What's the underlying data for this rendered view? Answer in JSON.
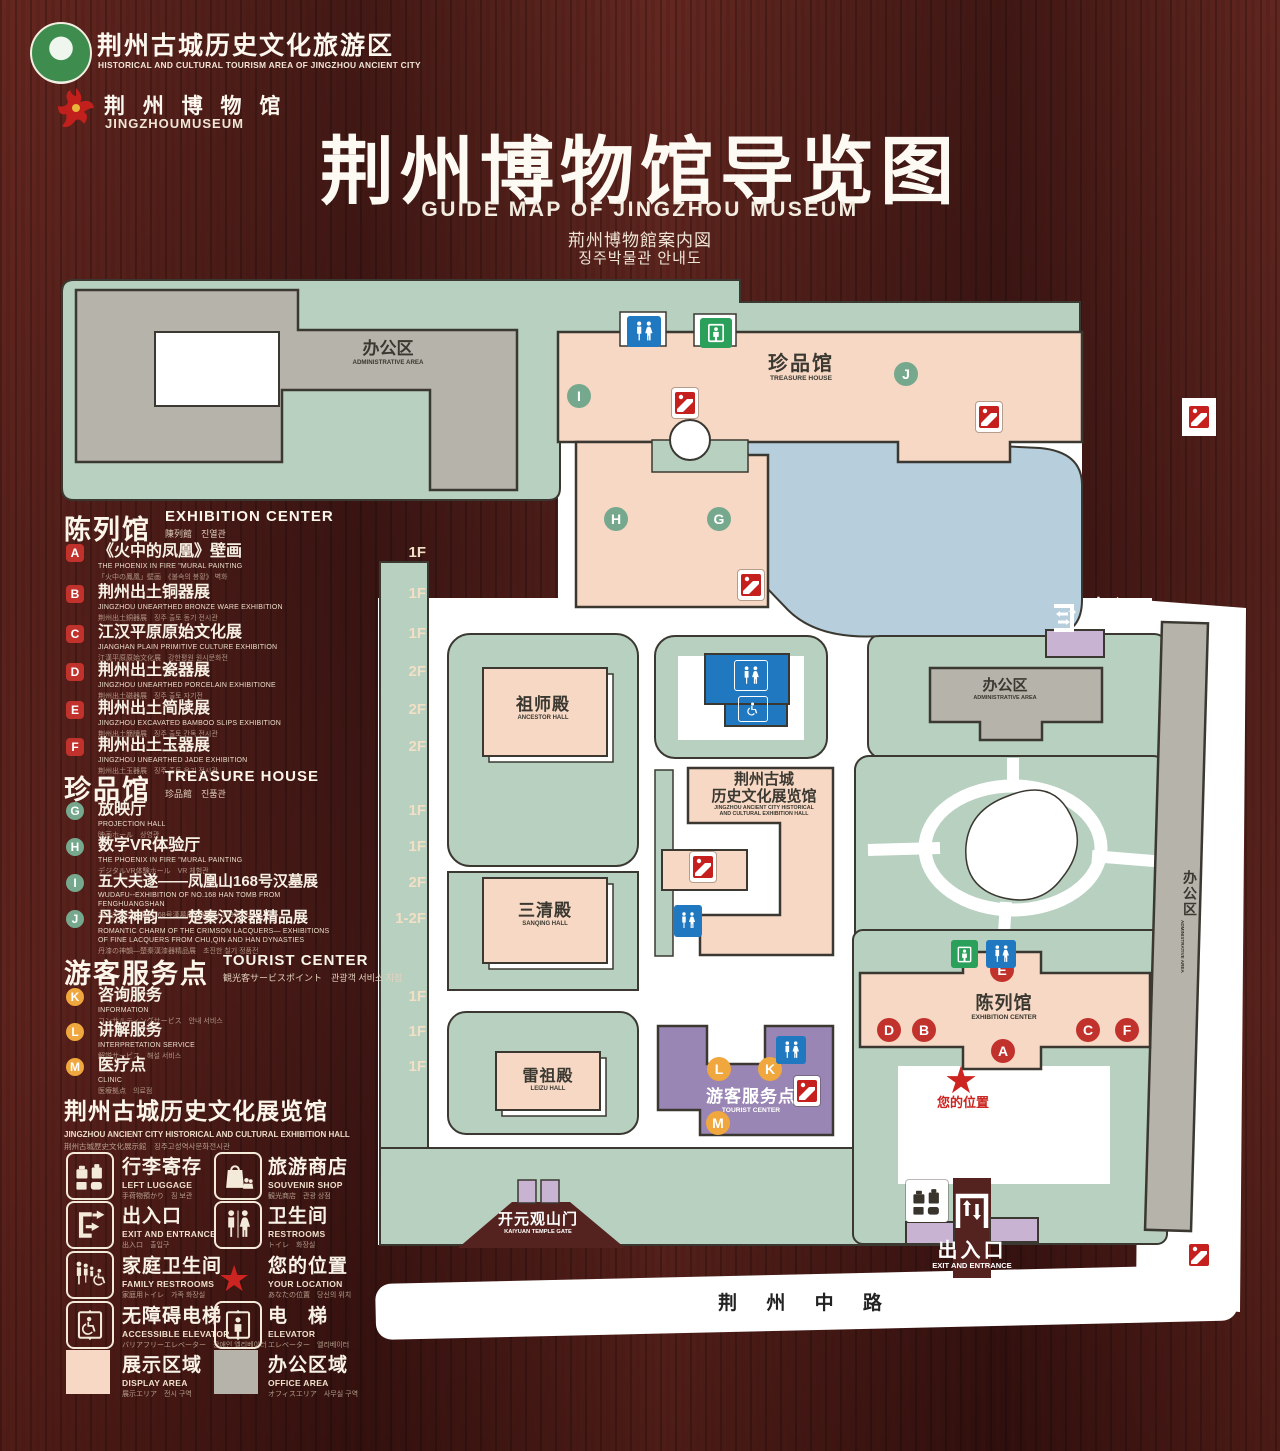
{
  "header": {
    "logo1_cn": "荆州古城历史文化旅游区",
    "logo1_en": "HISTORICAL AND CULTURAL TOURISM AREA OF JINGZHOU ANCIENT CITY",
    "logo2_cn": "荆 州 博 物 馆",
    "logo2_en": "JINGZHOUMUSEUM",
    "title_cn": "荆州博物馆导览图",
    "title_en": "GUIDE MAP OF JINGZHOU MUSEUM",
    "title_ja": "荊州博物館案内図",
    "title_ko": "징주박물관 안내도"
  },
  "sections": [
    {
      "title_cn": "陈列馆",
      "title_en": "EXHIBITION CENTER",
      "sub": "陳列館　진열관",
      "items": [
        {
          "letter": "A",
          "cn": "《火中的凤凰》壁画",
          "en": "THE PHOENIX IN FIRE \"MURAL PAINTING",
          "sub": "「火中の鳳凰」壁画　《불속의 봉황》 벽화",
          "floor": "1F"
        },
        {
          "letter": "B",
          "cn": "荆州出土铜器展",
          "en": "JINGZHOU UNEARTHED BRONZE WARE EXHIBITION",
          "sub": "荆州出土銅器展　징주 출토 동기 전시관",
          "floor": "1F"
        },
        {
          "letter": "C",
          "cn": "江汉平原原始文化展",
          "en": "JIANGHAN PLAIN PRIMITIVE CULTURE EXHIBITION",
          "sub": "江漢平原原始文化展　강한평원 원시문화전",
          "floor": "1F"
        },
        {
          "letter": "D",
          "cn": "荆州出土瓷器展",
          "en": "JINGZHOU UNEARTHED PORCELAIN EXHIBITIONE",
          "sub": "荆州出土磁器展　징주 출토 자기전",
          "floor": "2F"
        },
        {
          "letter": "E",
          "cn": "荆州出土简牍展",
          "en": "JINGZHOU EXCAVATED BAMBOO SLIPS EXHIBITION",
          "sub": "荆州出土簡牘展　징주 출토 간독 전시관",
          "floor": "2F"
        },
        {
          "letter": "F",
          "cn": "荆州出土玉器展",
          "en": "JINGZHOU UNEARTHED JADE EXHIBITION",
          "sub": "荆州出土玉器展　징주 출토 옥기 전시관",
          "floor": "2F"
        }
      ]
    },
    {
      "title_cn": "珍品馆",
      "title_en": "TREASURE HOUSE",
      "sub": "珍品館　진품관",
      "items": [
        {
          "letter": "G",
          "cn": "放映厅",
          "en": "PROJECTION HALL",
          "sub": "映画ホール　상영관",
          "floor": "1F"
        },
        {
          "letter": "H",
          "cn": "数字VR体验厅",
          "en": "THE PHOENIX IN FIRE \"MURAL PAINTING",
          "sub": "デジタルVR体験ホール　VR 체험관",
          "floor": "1F"
        },
        {
          "letter": "I",
          "cn": "五大夫遂——凤凰山168号汉墓展",
          "en": "WUDAFU--EXHIBITION OF NO.168 HAN TOMB FROM FENGHUANGSHAN",
          "sub": "五大夫遂—鳳凰山168号漢墓展　봉황산 168호 한묘전",
          "floor": "2F"
        },
        {
          "letter": "J",
          "cn": "丹漆神韵——楚秦汉漆器精品展",
          "en": "ROMANTIC CHARM OF THE CRIMSON LACQUERS— EXHIBITIONS OF FINE LACQUERS FROM CHU,QIN AND HAN DYNASTIES",
          "sub": "丹漆の神韻—楚秦漢漆器精品展　초진한 칠기 정품전",
          "floor": "1-2F"
        }
      ]
    },
    {
      "title_cn": "游客服务点",
      "title_en": "TOURIST CENTER",
      "sub": "観光客サービスポイント　관광객 서비스 지점",
      "items": [
        {
          "letter": "K",
          "cn": "咨询服务",
          "en": "INFORMATION",
          "sub": "コンサルティングサービス　안내 서비스",
          "floor": "1F"
        },
        {
          "letter": "L",
          "cn": "讲解服务",
          "en": "INTERPRETATION SERVICE",
          "sub": "解説サービス　해설 서비스",
          "floor": "1F"
        },
        {
          "letter": "M",
          "cn": "医疗点",
          "en": "CLINIC",
          "sub": "医療拠点　의료점",
          "floor": "1F"
        }
      ]
    }
  ],
  "hall_header": {
    "cn": "荆州古城历史文化展览馆",
    "en": "JINGZHOU ANCIENT CITY HISTORICAL AND CULTURAL EXHIBITION HALL",
    "sub": "荆州古城歴史文化展示館　징주고성역사문화전시관"
  },
  "legend": {
    "items": [
      {
        "icon": "left-luggage-icon",
        "cn": "行李寄存",
        "en": "LEFT LUGGAGE",
        "sub": "手荷物預かり　짐 보관"
      },
      {
        "icon": "souvenir-shop-icon",
        "cn": "旅游商店",
        "en": "SOUVENIR SHOP",
        "sub": "観光商店　관광 상점"
      },
      {
        "icon": "exit-entrance-icon",
        "cn": "出入口",
        "en": "EXIT AND ENTRANCE",
        "sub": "出入口　출입구"
      },
      {
        "icon": "restrooms-icon",
        "cn": "卫生间",
        "en": "RESTROOMS",
        "sub": "トイレ　화장실"
      },
      {
        "icon": "family-restrooms-icon",
        "cn": "家庭卫生间",
        "en": "FAMILY RESTROOMS",
        "sub": "家庭用トイレ　가족 화장실"
      },
      {
        "icon": "your-location-icon",
        "cn": "您的位置",
        "en": "YOUR LOCATION",
        "sub": "あなたの位置　당신의 위치"
      },
      {
        "icon": "accessible-elevator-icon",
        "cn": "无障碍电梯",
        "en": "ACCESSIBLE ELEVATOR",
        "sub": "バリアフリーエレベーター　장애인 엘리베이터"
      },
      {
        "icon": "elevator-icon",
        "cn": "电　梯",
        "en": "ELEVATOR",
        "sub": "エレベーター　엘리베이터"
      },
      {
        "icon": "display-area-swatch",
        "cn": "展示区域",
        "en": "DISPLAY AREA",
        "sub": "展示エリア　전시 구역"
      },
      {
        "icon": "office-area-swatch",
        "cn": "办公区域",
        "en": "OFFICE AREA",
        "sub": "オフィスエリア　사무실 구역"
      }
    ]
  },
  "map": {
    "admin_area_cn": "办公区",
    "admin_area_en": "ADMINISTRATIVE AREA",
    "treasure_cn": "珍品馆",
    "treasure_en": "TREASURE HOUSE",
    "exit_cn": "出入口",
    "exit_en": "EXIT AND ENTRANCE",
    "ancestor_cn": "祖师殿",
    "ancestor_en": "ANCESTOR HALL",
    "sanqing_cn": "三清殿",
    "sanqing_en": "SANQING HALL",
    "leizu_cn": "雷祖殿",
    "leizu_en": "LEIZU HALL",
    "exhibhall_cn1": "荆州古城",
    "exhibhall_cn2": "历史文化展览馆",
    "exhibhall_en1": "JINGZHOU ANCIENT CITY HISTORICAL",
    "exhibhall_en2": "AND CULTURAL EXHIBITION HALL",
    "tourist_cn": "游客服务点",
    "tourist_en": "TOURIST CENTER",
    "exhibition_cn": "陈列馆",
    "exhibition_en": "EXHIBITION CENTER",
    "location_cn": "您的位置",
    "kaiyuan_cn": "开元观山门",
    "kaiyuan_en": "KAIYUAN TEMPLE GATE",
    "road_cn": "荆 州 中 路",
    "markers": {
      "a": "A",
      "b": "B",
      "c": "C",
      "d": "D",
      "e": "E",
      "f": "F",
      "g": "G",
      "h": "H",
      "i": "I",
      "j": "J",
      "k": "K",
      "l": "L",
      "m": "M"
    }
  },
  "colors": {
    "wood": "#4a1e1b",
    "mint": "#b7d0c0",
    "gray_building": "#b5b3aa",
    "pink_building": "#f6d8c4",
    "purple_building": "#9a86b5",
    "gate_purple": "#c8b3d3",
    "water": "#b7cedd",
    "badge_red": "#c2322c",
    "badge_green": "#76a88e",
    "badge_orange": "#efa73e",
    "icon_blue": "#1f78c0",
    "icon_green": "#2aa05a",
    "star_red": "#cc2420"
  }
}
